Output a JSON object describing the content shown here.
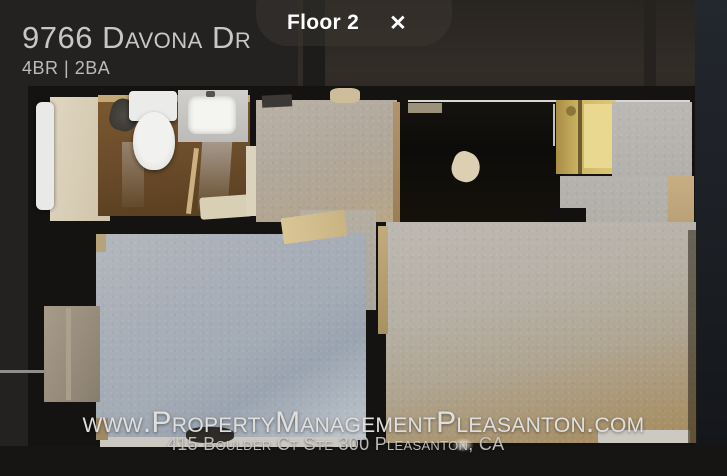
{
  "viewer": {
    "floor_pill": {
      "label": "Floor 2",
      "close_glyph": "✕"
    },
    "property": {
      "address": "9766 Davona Dr",
      "specs": "4BR | 2BA"
    },
    "watermark": {
      "url": "www.PropertyManagementPleasanton.com",
      "address_line": "415 Boulder Ct Ste 300 Pleasanton, CA"
    }
  },
  "colors": {
    "background": "#242221",
    "title_text": "#c9c7c5",
    "specs_text": "#bdbbb9",
    "floor_label_text": "#ffffff",
    "watermark_text": "#e0dfdd",
    "carpet_blue": "#a3abb5",
    "carpet_tan": "#a78e62",
    "bathroom_floor": "#6b4c2b",
    "closet_yellow": "#d2b968"
  }
}
